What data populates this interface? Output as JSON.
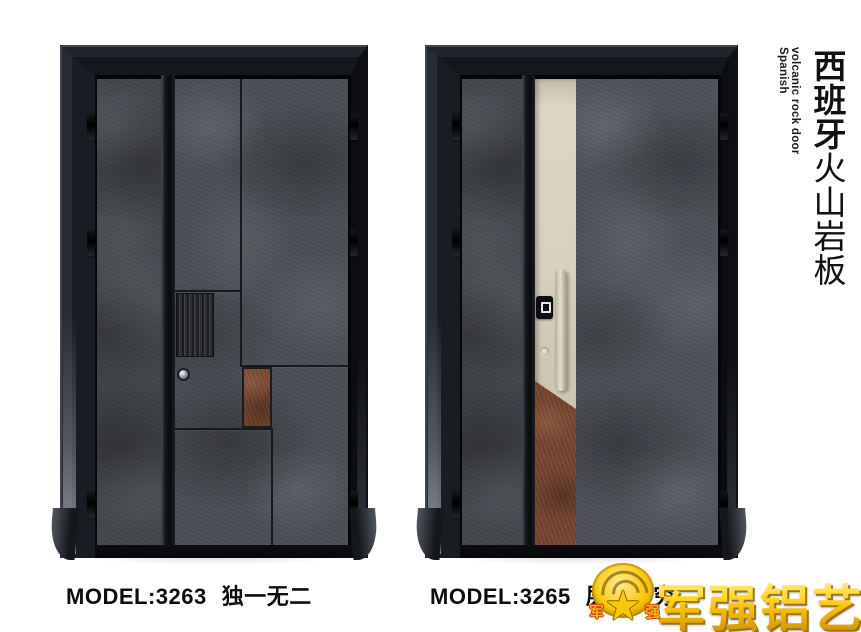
{
  "products": [
    {
      "model": "MODEL:3263",
      "tagline": "独一无二"
    },
    {
      "model": "MODEL:3265",
      "tagline": "层出不穷"
    }
  ],
  "side_title": {
    "en_line1": "Spanish",
    "en_line2": "volcanic rock door",
    "zh_primary": "西班牙",
    "zh_secondary": "火山岩板"
  },
  "brand": {
    "name": "军强铝艺",
    "emblem_left": "军",
    "emblem_right": "强",
    "emblem_star": "★"
  },
  "colors": {
    "background": "#ffffff",
    "frame_black": "#14161a",
    "rock_gray": "#4b4e54",
    "rust_accent": "#76452f",
    "champagne_strip": "#d8d1c1",
    "brand_gold": "#f6c60a",
    "label_text": "#0d0d0d"
  }
}
